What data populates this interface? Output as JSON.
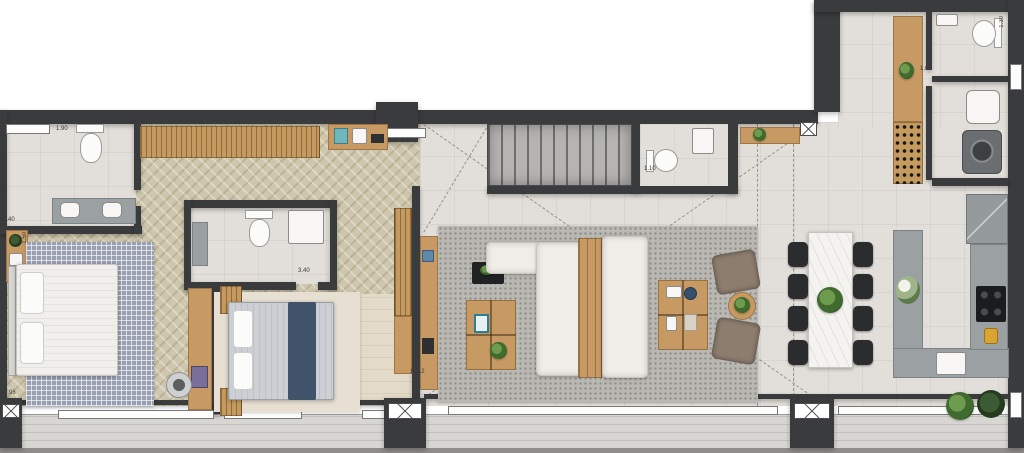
{
  "title": "apartment-floor-plan",
  "labels": {
    "master_bath_width": "1.90",
    "master_bath_length": "2.40",
    "master_bed_side": "1.50",
    "master_bed_width": "3.96",
    "suite2_bath_length": "3.40",
    "powder_room_width": "1.10",
    "living_terrace_width": "11.12",
    "kitchen_entry": "1.88",
    "laundry_width": "1.60",
    "service_wc_depth": "1.30"
  },
  "palette": {
    "wall": "#3a3b3d",
    "tile_floor": "#e2ded9",
    "herringbone_floor": "#cfc7ad",
    "wood_furniture": "#c79a63",
    "kitchen_counter": "#9ba0a2",
    "terrace_deck": "#d8d6d2",
    "sofa_white": "#efede7",
    "bed2_runner_navy": "#41536b",
    "dining_chair_black": "#2b2c2e",
    "plant_green": "#4a7d3a",
    "cooktop_black": "#1b1c1e",
    "accent_yellow": "#d9a431"
  }
}
